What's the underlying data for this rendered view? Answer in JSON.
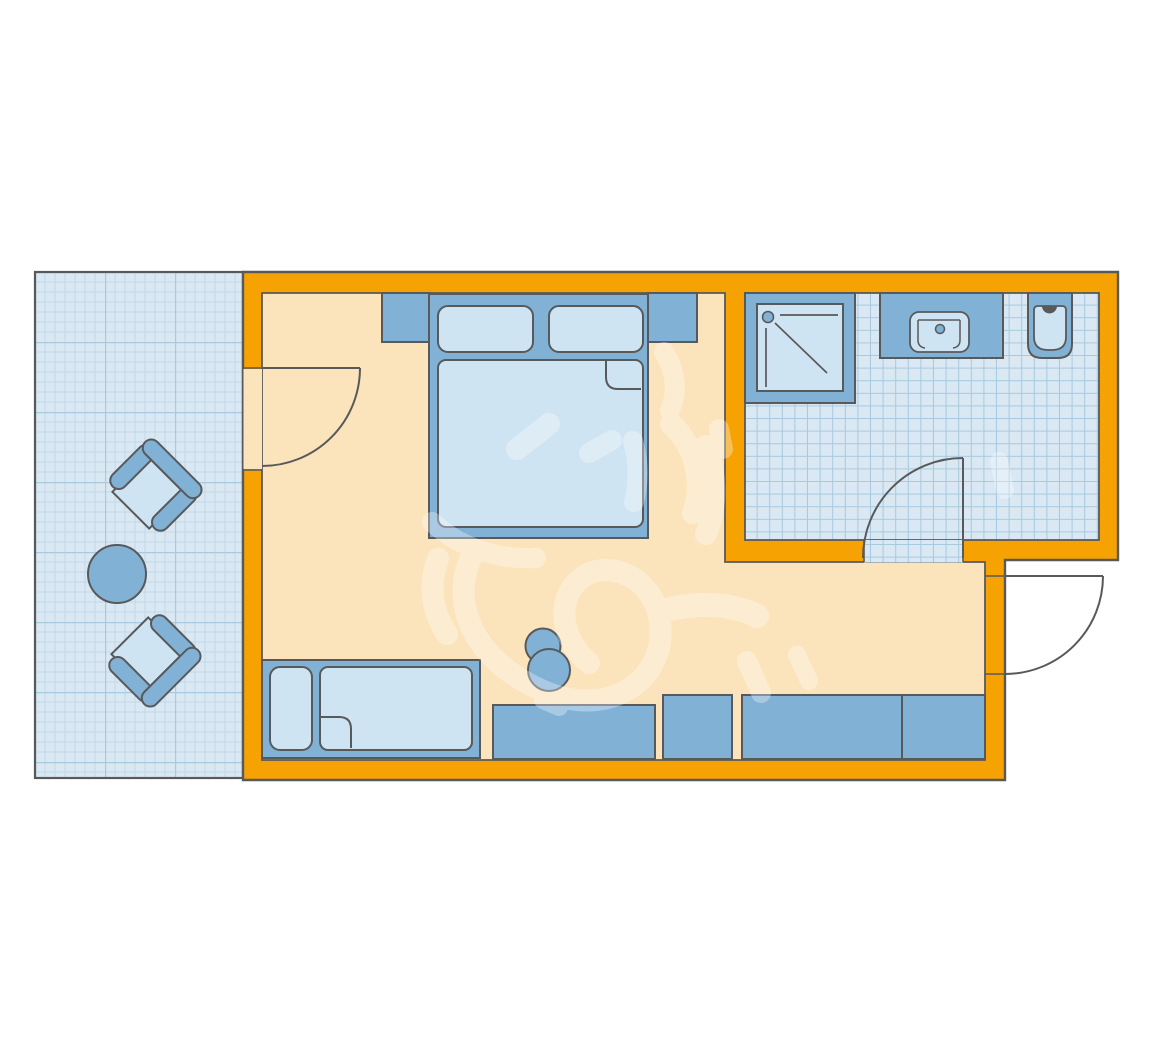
{
  "plan": {
    "kind": "hotel-room-floor-plan",
    "rooms": [
      "balcony",
      "bedroom-living-area",
      "hallway",
      "bathroom"
    ],
    "furniture": [
      "lounge-chair",
      "lounge-chair",
      "round-table",
      "double-bed",
      "pillow",
      "pillow",
      "mattress",
      "nightstand",
      "nightstand",
      "single-sofa-bed",
      "pillow",
      "mattress",
      "stool",
      "desk",
      "cabinet",
      "wardrobe",
      "cabinet",
      "shower",
      "sink",
      "toilet"
    ],
    "doors": [
      "balcony-door",
      "bathroom-door",
      "entrance-door"
    ],
    "decor": [
      "sun-heart-doodle-watermark"
    ]
  },
  "colors": {
    "background": "#FFFFFF",
    "wall": "#F5A202",
    "outline": "#58595B",
    "floor": "#FBE4BC",
    "furniture": "#81B2D5",
    "furniture_light": "#CFE4F2",
    "tile_bg": "#D9E8F3",
    "tile_minor": "#C3D9EA",
    "tile_major": "#A9C9DF",
    "bath_grid": "#A7C9DF",
    "watermark": "#FFFFFF"
  }
}
